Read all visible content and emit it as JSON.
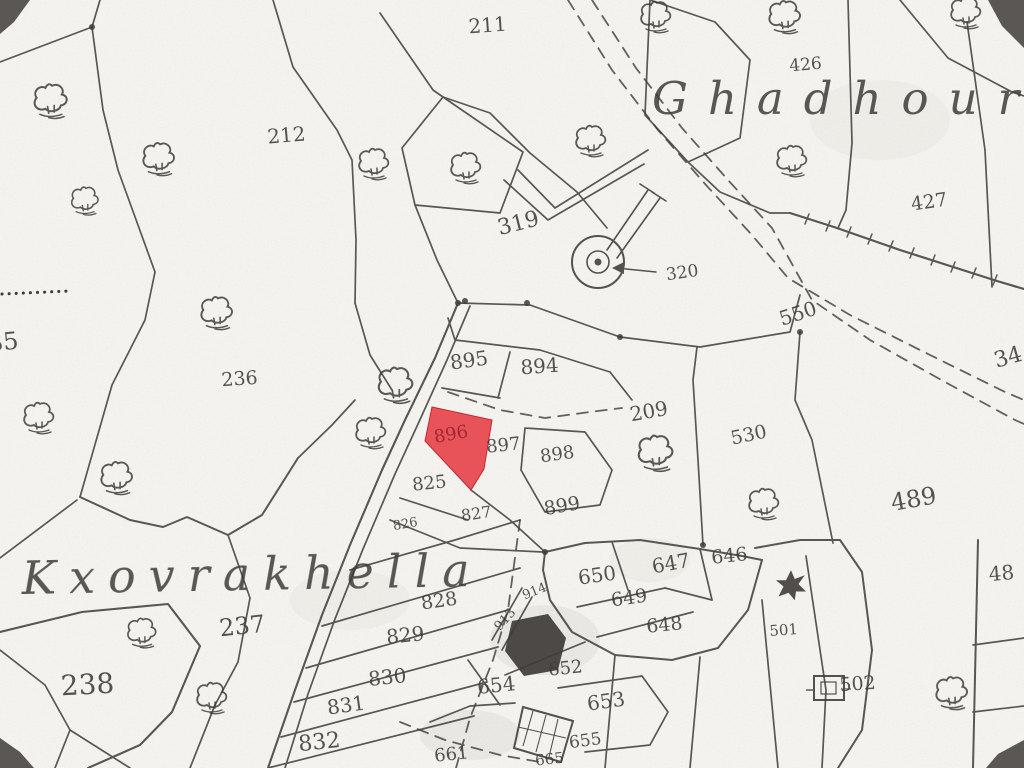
{
  "map": {
    "title": "Cadastral survey sheet (scanned)",
    "paper_color": "#f7f6f2",
    "ink_color": "#3f3c38",
    "highlight_parcel": {
      "label": "896",
      "fill": "#e6353c",
      "fill_opacity": 0.84,
      "stroke": "#c62730",
      "label_color": "#9c2730",
      "points": "432,407 492,420 484,469 471,490 425,441",
      "label_x": 452,
      "label_y": 440,
      "label_rotate": -10,
      "label_size": 18
    },
    "place_names": [
      {
        "id": "ghadhour",
        "text": "Ghadhour",
        "x": 652,
        "y": 114,
        "size": 45,
        "letter_spacing": 20,
        "rotate": 0
      },
      {
        "id": "kxovrakhella",
        "text": "Kxovrakhella",
        "x": 22,
        "y": 594,
        "size": 46,
        "letter_spacing": 13,
        "rotate": -1
      }
    ],
    "parcel_labels": [
      {
        "text": "211",
        "x": 488,
        "y": 32,
        "size": 20,
        "rotate": -4
      },
      {
        "text": "212",
        "x": 287,
        "y": 142,
        "size": 20,
        "rotate": -5
      },
      {
        "text": "319",
        "x": 520,
        "y": 230,
        "size": 22,
        "rotate": -14
      },
      {
        "text": "320",
        "x": 683,
        "y": 278,
        "size": 17,
        "rotate": -8
      },
      {
        "text": "426",
        "x": 806,
        "y": 70,
        "size": 17,
        "rotate": -5
      },
      {
        "text": "427",
        "x": 930,
        "y": 208,
        "size": 19,
        "rotate": -8
      },
      {
        "text": "550",
        "x": 800,
        "y": 320,
        "size": 20,
        "rotate": -18
      },
      {
        "text": "236",
        "x": 240,
        "y": 385,
        "size": 19,
        "rotate": -4
      },
      {
        "text": "35",
        "x": 4,
        "y": 350,
        "size": 24,
        "rotate": -6
      },
      {
        "text": "237",
        "x": 243,
        "y": 634,
        "size": 24,
        "rotate": -6
      },
      {
        "text": "238",
        "x": 88,
        "y": 694,
        "size": 28,
        "rotate": -3
      },
      {
        "text": "209",
        "x": 650,
        "y": 418,
        "size": 20,
        "rotate": -10
      },
      {
        "text": "530",
        "x": 750,
        "y": 441,
        "size": 19,
        "rotate": -12
      },
      {
        "text": "489",
        "x": 915,
        "y": 507,
        "size": 24,
        "rotate": -10
      },
      {
        "text": "34",
        "x": 1010,
        "y": 364,
        "size": 22,
        "rotate": -16
      },
      {
        "text": "48",
        "x": 1002,
        "y": 580,
        "size": 20,
        "rotate": -5
      },
      {
        "text": "895",
        "x": 470,
        "y": 367,
        "size": 20,
        "rotate": -8
      },
      {
        "text": "894",
        "x": 540,
        "y": 373,
        "size": 20,
        "rotate": -4
      },
      {
        "text": "897",
        "x": 504,
        "y": 451,
        "size": 18,
        "rotate": -6
      },
      {
        "text": "898",
        "x": 558,
        "y": 460,
        "size": 18,
        "rotate": -8
      },
      {
        "text": "899",
        "x": 563,
        "y": 512,
        "size": 19,
        "rotate": -10
      },
      {
        "text": "825",
        "x": 430,
        "y": 489,
        "size": 18,
        "rotate": -6
      },
      {
        "text": "826",
        "x": 406,
        "y": 528,
        "size": 13,
        "rotate": -10
      },
      {
        "text": "827",
        "x": 477,
        "y": 519,
        "size": 16,
        "rotate": -8
      },
      {
        "text": "828",
        "x": 440,
        "y": 607,
        "size": 19,
        "rotate": -8
      },
      {
        "text": "829",
        "x": 406,
        "y": 642,
        "size": 20,
        "rotate": -6
      },
      {
        "text": "830",
        "x": 388,
        "y": 684,
        "size": 20,
        "rotate": -6
      },
      {
        "text": "831",
        "x": 347,
        "y": 712,
        "size": 20,
        "rotate": -8
      },
      {
        "text": "832",
        "x": 320,
        "y": 749,
        "size": 22,
        "rotate": -6
      },
      {
        "text": "650",
        "x": 598,
        "y": 582,
        "size": 20,
        "rotate": -8
      },
      {
        "text": "647",
        "x": 672,
        "y": 570,
        "size": 20,
        "rotate": -10
      },
      {
        "text": "646",
        "x": 730,
        "y": 562,
        "size": 19,
        "rotate": -6
      },
      {
        "text": "649",
        "x": 630,
        "y": 604,
        "size": 19,
        "rotate": -8
      },
      {
        "text": "648",
        "x": 665,
        "y": 631,
        "size": 19,
        "rotate": -6
      },
      {
        "text": "913",
        "x": 508,
        "y": 622,
        "size": 13,
        "rotate": -48
      },
      {
        "text": "914",
        "x": 536,
        "y": 595,
        "size": 13,
        "rotate": -22
      },
      {
        "text": "652",
        "x": 566,
        "y": 674,
        "size": 18,
        "rotate": -6
      },
      {
        "text": "654",
        "x": 497,
        "y": 692,
        "size": 20,
        "rotate": -6
      },
      {
        "text": "653",
        "x": 607,
        "y": 708,
        "size": 20,
        "rotate": -8
      },
      {
        "text": "655",
        "x": 586,
        "y": 746,
        "size": 17,
        "rotate": -8
      },
      {
        "text": "661",
        "x": 452,
        "y": 760,
        "size": 18,
        "rotate": -6
      },
      {
        "text": "665",
        "x": 550,
        "y": 764,
        "size": 15,
        "rotate": -6
      },
      {
        "text": "501",
        "x": 784,
        "y": 635,
        "size": 15,
        "rotate": -4
      },
      {
        "text": "502",
        "x": 858,
        "y": 690,
        "size": 19,
        "rotate": -4
      }
    ],
    "boundaries": [
      {
        "p": "0,62 92,27 100,0"
      },
      {
        "p": "92,27 103,110 118,170 155,272"
      },
      {
        "p": "155,272 145,320 112,385 80,497"
      },
      {
        "p": "80,497 130,520 163,527 187,517 228,535",
        "w": 2
      },
      {
        "p": "228,535 262,515 298,458",
        "w": 2
      },
      {
        "p": "298,458 332,425 355,400"
      },
      {
        "p": "380,13 433,90 443,97"
      },
      {
        "p": "443,97 490,113 530,153 577,192 607,228"
      },
      {
        "p": "273,0 293,67 337,130 352,160 356,240 355,303"
      },
      {
        "p": "355,303 370,355 392,390"
      },
      {
        "p": "443,97 402,148 415,205 500,213 523,152 443,97"
      },
      {
        "p": "415,205 437,260 458,303"
      },
      {
        "p": "518,170 555,208 648,150"
      },
      {
        "p": "504,180 548,220 644,164"
      },
      {
        "p": "458,303 530,305 620,337 700,347 790,332 800,295"
      },
      {
        "p": "697,347 693,380 698,460 703,545"
      },
      {
        "p": "800,332 795,400 812,440 833,543"
      },
      {
        "p": "650,0 715,22 750,60 740,138 688,162 645,115 650,0"
      },
      {
        "p": "688,162 720,192 770,213 790,213"
      },
      {
        "p": "848,0 852,143 846,210 838,228"
      },
      {
        "p": "967,22 985,150 992,287"
      },
      {
        "p": "900,0 948,58 1012,92 1024,96"
      },
      {
        "p": "448,318 455,340 540,350 610,372"
      },
      {
        "p": "510,352 498,398"
      },
      {
        "p": "442,388 500,398"
      },
      {
        "p": "610,372 632,400"
      },
      {
        "p": "525,428 585,432 612,470 600,505 545,512 521,470 525,428"
      },
      {
        "p": "471,490 510,520 545,552"
      },
      {
        "p": "400,498 468,520"
      },
      {
        "p": "390,520 460,548 543,552"
      },
      {
        "p": "458,303 435,358 405,420 382,470 350,545 322,615 295,690 268,768",
        "w": 2.1
      },
      {
        "p": "470,306 447,360 418,424 395,474 363,549 335,619 308,694 285,768",
        "w": 1.7
      },
      {
        "p": "350,570 455,540 520,520"
      },
      {
        "p": "322,626 520,568"
      },
      {
        "p": "306,668 508,610"
      },
      {
        "p": "294,702 498,647"
      },
      {
        "p": "281,737 487,682"
      },
      {
        "p": "268,768 474,716"
      },
      {
        "p": "545,552 585,543 640,540 700,549 742,556 762,560",
        "w": 2
      },
      {
        "p": "762,560 748,610 718,648 672,660 615,655 572,632 550,600 543,570 545,552",
        "w": 2
      },
      {
        "p": "577,607 665,588"
      },
      {
        "p": "597,637 693,612"
      },
      {
        "p": "612,542 628,590"
      },
      {
        "p": "700,549 712,600"
      },
      {
        "p": "665,588 712,600"
      },
      {
        "p": "978,540 973,768",
        "w": 2
      },
      {
        "p": "755,548 800,540 840,540 862,572 872,650 862,730 838,768",
        "w": 2
      },
      {
        "p": "762,600 778,768"
      },
      {
        "p": "806,556 826,690 822,768"
      },
      {
        "p": "973,645 1024,638"
      },
      {
        "p": "973,712 1024,706"
      },
      {
        "p": "0,650 45,685 70,730 55,768"
      },
      {
        "p": "70,730 130,768"
      },
      {
        "p": "0,632 82,612 168,604 200,646 172,712 140,745 88,768",
        "w": 2.1
      },
      {
        "p": "0,558 77,500"
      },
      {
        "p": "228,535 250,598 238,662 215,705 190,768"
      },
      {
        "p": "558,688 642,676 668,712 650,745 585,752"
      },
      {
        "p": "700,657 690,768"
      },
      {
        "p": "615,655 605,768"
      },
      {
        "p": "505,675 585,642"
      },
      {
        "p": "492,640 522,588"
      },
      {
        "p": "502,650 532,597"
      },
      {
        "p": "468,660 500,705"
      },
      {
        "p": "430,722 470,706 515,703"
      },
      {
        "p": "790,213 834,227 900,250 997,281 1024,289",
        "w": 2.2
      }
    ],
    "dashed_paths": [
      {
        "p": "568,0 612,70 658,130 706,185 752,235 788,278 850,315 930,355 1005,392 1024,400"
      },
      {
        "p": "592,0 636,68 682,128 728,180 772,228 812,300 870,340 945,382 1015,420 1024,424"
      },
      {
        "p": "448,392 500,410 545,418 590,412 622,408"
      },
      {
        "p": "520,520 508,610 493,660 470,718 456,768"
      },
      {
        "p": "400,722 445,740 500,755 540,762"
      }
    ],
    "dotted_row": {
      "p": "2,294 70,291"
    },
    "wall_ticks": [
      [
        807,
        219
      ],
      [
        828,
        226
      ],
      [
        849,
        232
      ],
      [
        870,
        239
      ],
      [
        891,
        246
      ],
      [
        912,
        253
      ],
      [
        933,
        260
      ],
      [
        953,
        267
      ],
      [
        974,
        273
      ],
      [
        995,
        280
      ]
    ],
    "survey_dots": [
      [
        465,
        301
      ],
      [
        527,
        303
      ],
      [
        620,
        337
      ],
      [
        800,
        332
      ],
      [
        545,
        552
      ],
      [
        703,
        545
      ],
      [
        458,
        303
      ],
      [
        92,
        27
      ]
    ],
    "trees": [
      [
        52,
        100,
        1.1
      ],
      [
        160,
        158,
        1.05
      ],
      [
        86,
        200,
        0.9
      ],
      [
        375,
        163,
        1.0
      ],
      [
        467,
        167,
        1.0
      ],
      [
        592,
        140,
        1.0
      ],
      [
        657,
        16,
        1.0
      ],
      [
        786,
        16,
        1.05
      ],
      [
        793,
        160,
        1.0
      ],
      [
        967,
        12,
        1.0
      ],
      [
        218,
        312,
        1.05
      ],
      [
        40,
        417,
        1.0
      ],
      [
        118,
        477,
        1.05
      ],
      [
        397,
        384,
        1.15
      ],
      [
        372,
        432,
        1.0
      ],
      [
        143,
        632,
        0.95
      ],
      [
        213,
        697,
        1.0
      ],
      [
        657,
        452,
        1.15
      ],
      [
        765,
        503,
        1.0
      ],
      [
        953,
        692,
        1.05
      ]
    ],
    "well_symbol": {
      "cx": 598,
      "cy": 262,
      "outer_r": 26,
      "mid_r": 11,
      "dot_r": 3.5,
      "lane": [
        "607,250 648,190",
        "617,258 660,198",
        "640,184 654,193",
        "652,192 666,201"
      ],
      "arrow_line": "656,272 616,268",
      "arrow_head": "612,268 624,262 624,274"
    },
    "buildings": {
      "solid_ruin": "512,621 548,614 566,638 558,670 524,676 505,651",
      "hatched_outline": "523,707 573,721 561,762 514,748",
      "hatch_lines": [
        "533,711 523,746",
        "546,715 536,752",
        "558,719 549,757",
        "518,727 566,738"
      ],
      "b502_outer": [
        814,
        676,
        30,
        24
      ],
      "b502_inner": [
        821,
        682,
        15,
        12
      ],
      "b502_tick": "806,690 814,690",
      "b502_link": "844,689 851,689"
    },
    "leaf_501": {
      "x": 791,
      "y": 584,
      "scale": 1.25
    },
    "corner_stains": [
      "M0,0 L30,0 L14,22 L0,34 Z",
      "M1024,0 L988,0 L1002,26 L1024,48 Z",
      "M0,768 L0,738 L20,752 L34,768 Z",
      "M1024,768 L1024,740 L998,754 L986,768 Z"
    ],
    "shade_blobs": [
      [
        545,
        640,
        55,
        35,
        0.05
      ],
      [
        350,
        600,
        60,
        30,
        0.03
      ],
      [
        470,
        735,
        50,
        25,
        0.05
      ],
      [
        880,
        120,
        70,
        40,
        0.03
      ],
      [
        650,
        560,
        40,
        22,
        0.03
      ]
    ]
  }
}
